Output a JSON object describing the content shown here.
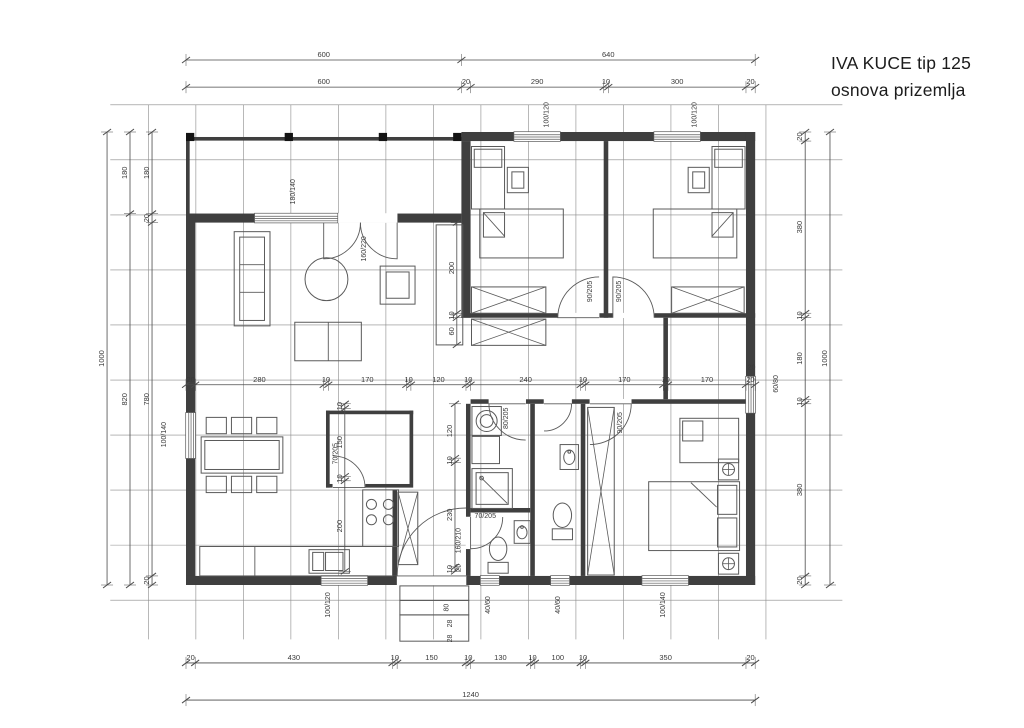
{
  "title": {
    "line1": "IVA KUCE tip 125",
    "line2": "osnova prizemlja"
  },
  "colors": {
    "wall": "#3f3f3f",
    "post": "#141414",
    "thin": "#5a5a5a",
    "grid": "#8a8a8a",
    "dim": "#4a4a4a",
    "text": "#3a3a3a",
    "bg": "#ffffff"
  },
  "plan": {
    "origin_px": [
      186,
      132
    ],
    "scale_px_per_cm": [
      0.459,
      0.453
    ],
    "grid": {
      "v": {
        "start": -82,
        "step": 103.5,
        "count": 14,
        "a": -60,
        "b": 1120
      },
      "h": {
        "start": -60,
        "step": 121.5,
        "count": 10,
        "a": -165,
        "b": 1430
      }
    },
    "walls": [
      [
        600,
        0,
        640,
        20
      ],
      [
        0,
        180,
        600,
        20
      ],
      [
        0,
        180,
        20,
        820
      ],
      [
        1220,
        0,
        20,
        1000
      ],
      [
        0,
        980,
        1240,
        20
      ],
      [
        0,
        11,
        600,
        8
      ],
      [
        0,
        11,
        8,
        169
      ],
      [
        600,
        20,
        20,
        390
      ],
      [
        910,
        20,
        10,
        390
      ],
      [
        600,
        400,
        210,
        10
      ],
      [
        900,
        400,
        30,
        10
      ],
      [
        1020,
        400,
        220,
        10
      ],
      [
        620,
        590,
        40,
        10
      ],
      [
        740,
        590,
        40,
        10
      ],
      [
        840,
        590,
        40,
        10
      ],
      [
        970,
        590,
        270,
        10
      ],
      [
        610,
        600,
        10,
        250
      ],
      [
        610,
        920,
        10,
        60
      ],
      [
        750,
        600,
        10,
        380
      ],
      [
        620,
        830,
        130,
        10
      ],
      [
        860,
        600,
        10,
        380
      ],
      [
        305,
        615,
        190,
        8
      ],
      [
        305,
        615,
        8,
        170
      ],
      [
        487,
        615,
        8,
        162
      ],
      [
        305,
        777,
        15,
        8
      ],
      [
        390,
        777,
        105,
        8
      ],
      [
        450,
        790,
        10,
        190
      ],
      [
        1040,
        410,
        10,
        180
      ]
    ],
    "posts": [
      [
        0,
        2,
        18,
        18
      ],
      [
        215,
        2,
        18,
        18
      ],
      [
        420,
        2,
        18,
        18
      ],
      [
        582,
        2,
        18,
        18
      ]
    ],
    "openings": [
      [
        300,
        180,
        160,
        20
      ],
      [
        460,
        980,
        150,
        20
      ],
      [
        810,
        400,
        90,
        10
      ],
      [
        930,
        400,
        90,
        10
      ],
      [
        660,
        590,
        80,
        10
      ],
      [
        780,
        590,
        60,
        10
      ],
      [
        880,
        590,
        90,
        10
      ],
      [
        610,
        850,
        10,
        70
      ],
      [
        320,
        777,
        70,
        8
      ]
    ],
    "windows": [
      [
        715,
        0,
        100,
        20,
        "h"
      ],
      [
        1020,
        0,
        100,
        20,
        "h"
      ],
      [
        150,
        180,
        180,
        20,
        "h"
      ],
      [
        0,
        620,
        20,
        100,
        "v"
      ],
      [
        1220,
        540,
        20,
        80,
        "v"
      ],
      [
        295,
        980,
        100,
        20,
        "h"
      ],
      [
        642,
        980,
        40,
        20,
        "h"
      ],
      [
        795,
        980,
        40,
        20,
        "h"
      ],
      [
        994,
        980,
        100,
        20,
        "h"
      ]
    ],
    "furniture": [
      [
        105,
        220,
        78,
        208,
        0
      ],
      [
        117,
        232,
        54,
        184,
        0
      ],
      [
        423,
        296,
        76,
        84,
        0
      ],
      [
        436,
        309,
        50,
        58,
        0
      ],
      [
        237,
        420,
        145,
        85,
        0
      ],
      [
        545,
        205,
        58,
        265,
        0
      ],
      [
        33,
        673,
        178,
        80,
        0
      ],
      [
        41,
        681,
        162,
        64,
        0
      ],
      [
        44,
        630,
        44,
        36,
        0
      ],
      [
        99,
        630,
        44,
        36,
        0
      ],
      [
        154,
        630,
        44,
        36,
        0
      ],
      [
        44,
        760,
        44,
        36,
        0
      ],
      [
        99,
        760,
        44,
        36,
        0
      ],
      [
        154,
        760,
        44,
        36,
        0
      ],
      [
        30,
        915,
        420,
        65,
        0
      ],
      [
        268,
        922,
        88,
        52,
        0
      ],
      [
        276,
        928,
        24,
        40,
        0
      ],
      [
        304,
        928,
        38,
        40,
        0
      ],
      [
        385,
        790,
        78,
        125,
        0
      ],
      [
        462,
        795,
        43,
        160,
        1
      ],
      [
        623,
        606,
        64,
        64,
        0
      ],
      [
        623,
        672,
        60,
        60,
        0
      ],
      [
        623,
        743,
        88,
        88,
        0
      ],
      [
        632,
        752,
        70,
        70,
        0
      ],
      [
        715,
        858,
        35,
        50,
        0
      ],
      [
        658,
        950,
        44,
        24,
        0
      ],
      [
        815,
        690,
        40,
        55,
        0
      ],
      [
        798,
        876,
        44,
        24,
        0
      ],
      [
        622,
        32,
        72,
        138,
        0
      ],
      [
        628,
        38,
        60,
        40,
        0
      ],
      [
        700,
        78,
        46,
        56,
        0
      ],
      [
        710,
        88,
        26,
        36,
        0
      ],
      [
        640,
        170,
        182,
        108,
        0
      ],
      [
        648,
        178,
        46,
        54,
        0
      ],
      [
        622,
        342,
        162,
        58,
        1
      ],
      [
        622,
        413,
        162,
        58,
        1
      ],
      [
        1146,
        32,
        72,
        138,
        0
      ],
      [
        1152,
        38,
        60,
        40,
        0
      ],
      [
        1094,
        78,
        46,
        56,
        0
      ],
      [
        1104,
        88,
        26,
        36,
        0
      ],
      [
        1018,
        170,
        182,
        108,
        0
      ],
      [
        1146,
        178,
        46,
        54,
        0
      ],
      [
        1058,
        342,
        158,
        58,
        1
      ],
      [
        875,
        608,
        58,
        370,
        1
      ],
      [
        1076,
        632,
        128,
        98,
        0
      ],
      [
        1082,
        638,
        44,
        44,
        0
      ],
      [
        1008,
        772,
        198,
        152,
        0
      ],
      [
        1158,
        780,
        42,
        64,
        0
      ],
      [
        1158,
        852,
        42,
        64,
        0
      ],
      [
        1160,
        722,
        44,
        46,
        0
      ],
      [
        1160,
        930,
        44,
        46,
        0
      ],
      [
        466,
        1002,
        150,
        32,
        0
      ],
      [
        466,
        1034,
        150,
        32,
        0
      ],
      [
        466,
        1066,
        150,
        58,
        0
      ]
    ],
    "circles": [
      [
        306,
        325,
        47,
        0
      ],
      [
        655,
        638,
        23,
        0
      ],
      [
        655,
        638,
        14,
        0
      ],
      [
        404,
        822,
        11,
        0
      ],
      [
        441,
        822,
        11,
        0
      ],
      [
        404,
        856,
        11,
        0
      ],
      [
        441,
        856,
        11,
        0
      ],
      [
        644,
        764,
        4,
        0
      ],
      [
        1182,
        745,
        13,
        1
      ],
      [
        1182,
        953,
        13,
        1
      ],
      [
        732,
        872,
        3,
        0
      ],
      [
        835,
        706,
        3,
        0
      ]
    ],
    "ellipses": [
      [
        732,
        884,
        11,
        14
      ],
      [
        680,
        920,
        19,
        26
      ],
      [
        835,
        718,
        12,
        16
      ],
      [
        820,
        846,
        20,
        27
      ]
    ],
    "lines": [
      [
        117,
        293,
        171,
        293
      ],
      [
        117,
        354,
        171,
        354
      ],
      [
        310,
        420,
        310,
        505
      ],
      [
        150,
        915,
        150,
        980
      ],
      [
        640,
        760,
        700,
        820
      ],
      [
        648,
        178,
        694,
        230
      ],
      [
        1192,
        178,
        1146,
        230
      ],
      [
        1100,
        774,
        1156,
        828
      ]
    ],
    "door_arcs": [
      [
        300,
        200,
        80,
        90,
        0
      ],
      [
        460,
        200,
        80,
        90,
        180
      ],
      [
        900,
        410,
        90,
        180,
        270
      ],
      [
        930,
        410,
        90,
        270,
        360
      ],
      [
        880,
        600,
        90,
        0,
        90
      ],
      [
        740,
        600,
        80,
        180,
        90
      ],
      [
        780,
        600,
        60,
        0,
        90
      ],
      [
        620,
        850,
        70,
        90,
        0
      ],
      [
        320,
        785,
        70,
        0,
        -90
      ],
      [
        610,
        980,
        150,
        180,
        270
      ]
    ],
    "dim_chains": [
      {
        "o": "h",
        "p": -159,
        "s": 0,
        "v": [
          600,
          640
        ]
      },
      {
        "o": "h",
        "p": -99,
        "s": 0,
        "v": [
          600,
          20,
          290,
          10,
          300,
          20
        ]
      },
      {
        "o": "v",
        "p": -172,
        "s": 0,
        "v": [
          1000
        ]
      },
      {
        "o": "v",
        "p": -122,
        "s": 0,
        "v": [
          180,
          820
        ]
      },
      {
        "o": "v",
        "p": -74,
        "s": 0,
        "v": [
          180,
          20,
          780,
          20
        ]
      },
      {
        "o": "v",
        "p": 1349,
        "s": 0,
        "v": [
          20,
          380,
          10,
          180,
          10,
          380,
          20
        ]
      },
      {
        "o": "v",
        "p": 1403,
        "s": 0,
        "v": [
          1000
        ]
      },
      {
        "o": "h",
        "p": 1172,
        "s": 0,
        "v": [
          20,
          430,
          10,
          150,
          10,
          130,
          10,
          100,
          10,
          350,
          20
        ]
      },
      {
        "o": "h",
        "p": 1254,
        "s": 0,
        "v": [
          1240
        ]
      },
      {
        "o": "h",
        "p": 558,
        "s": 0,
        "v": [
          20,
          280,
          10,
          170,
          10,
          120,
          10,
          240,
          10,
          170,
          10,
          170,
          20
        ]
      },
      {
        "o": "v",
        "p": 590,
        "s": 200,
        "v": [
          200,
          10,
          60
        ]
      },
      {
        "o": "v",
        "p": 346,
        "s": 600,
        "v": [
          10,
          150,
          10,
          200
        ]
      },
      {
        "o": "v",
        "p": 586,
        "s": 600,
        "v": [
          120,
          10,
          230,
          10
        ]
      }
    ],
    "labels": [
      [
        "100/120",
        790,
        -38,
        -90
      ],
      [
        "100/120",
        1112,
        -38,
        -90
      ],
      [
        "180/140",
        237,
        132,
        -90
      ],
      [
        "160/220",
        392,
        258,
        -90
      ],
      [
        "90/205",
        884,
        352,
        -90
      ],
      [
        "90/205",
        948,
        352,
        -90
      ],
      [
        "70/205",
        330,
        710,
        -90
      ],
      [
        "80/205",
        702,
        632,
        -90
      ],
      [
        "90/205",
        950,
        642,
        -90
      ],
      [
        "70/205",
        652,
        852,
        0
      ],
      [
        "160/210",
        598,
        902,
        -90
      ],
      [
        "20",
        598,
        962,
        -90
      ],
      [
        "100/140",
        -44,
        668,
        -90
      ],
      [
        "60/80",
        1290,
        556,
        -90
      ],
      [
        "20",
        1232,
        524,
        0
      ],
      [
        "100/120",
        314,
        1044,
        -90
      ],
      [
        "40/60",
        662,
        1044,
        -90
      ],
      [
        "40/60",
        815,
        1044,
        -90
      ],
      [
        "100/140",
        1044,
        1044,
        -90
      ],
      [
        "80",
        572,
        1050,
        -90
      ],
      [
        "28",
        580,
        1085,
        -90
      ],
      [
        "28",
        580,
        1118,
        -90
      ]
    ]
  }
}
